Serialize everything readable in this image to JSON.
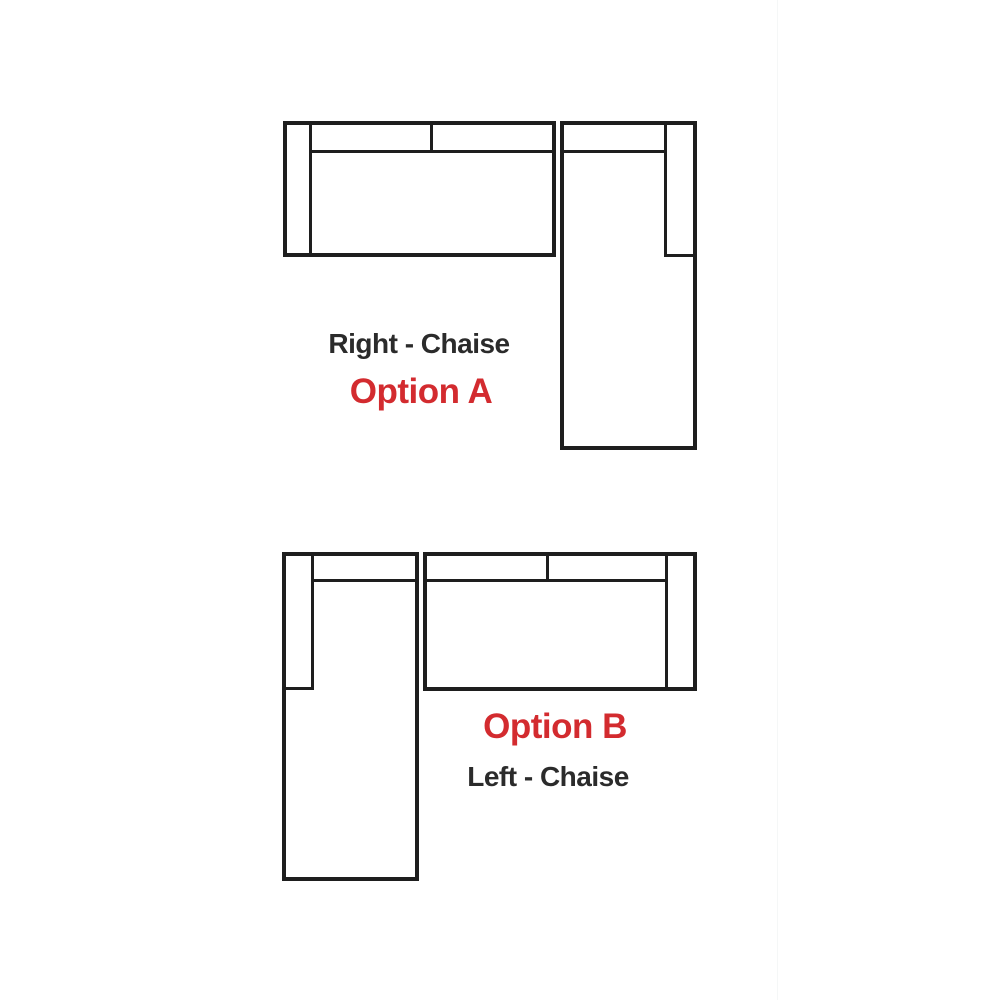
{
  "colors": {
    "line": "#1e1e1e",
    "label_dark": "#2b2b2b",
    "label_red": "#d32b2f",
    "background": "#ffffff"
  },
  "option_a": {
    "type_label": "Right - Chaise",
    "option_label": "Option A"
  },
  "option_b": {
    "option_label": "Option B",
    "type_label": "Left - Chaise"
  }
}
